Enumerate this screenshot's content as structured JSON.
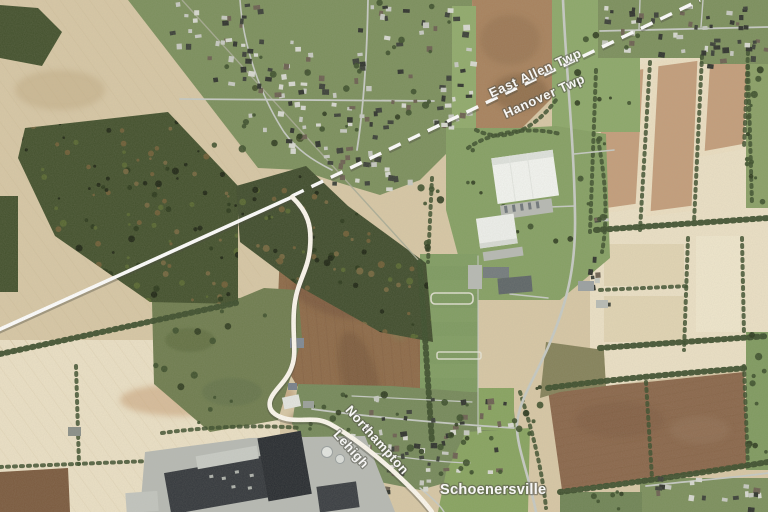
{
  "map": {
    "type": "aerial-imagery",
    "boundary_labels": {
      "east_allen_twp": "East Allen Twp",
      "hanover_twp": "Hanover Twp",
      "northampton_county": "Northampton",
      "lehigh_county": "Lehigh"
    },
    "place_labels": {
      "schoenersville": "Schoenersville"
    },
    "palette": {
      "field_tan": "#d8c8a6",
      "field_cream": "#ece1c6",
      "field_brown": "#8d6947",
      "field_tan_dark": "#c49e7b",
      "forest_dark": "#42502c",
      "grass_green": "#7b8f5c",
      "lawn_green": "#87a35f",
      "tree_green": "#3b4d2b",
      "road_gray": "#c6cac4",
      "pavement_gray": "#b7bab4",
      "roof_dark": "#33373c",
      "roof_white": "#f3f5f1",
      "boundary_white": "#ffffff",
      "label_white": "#ffffff",
      "label_shadow": "#4a4a42"
    }
  }
}
